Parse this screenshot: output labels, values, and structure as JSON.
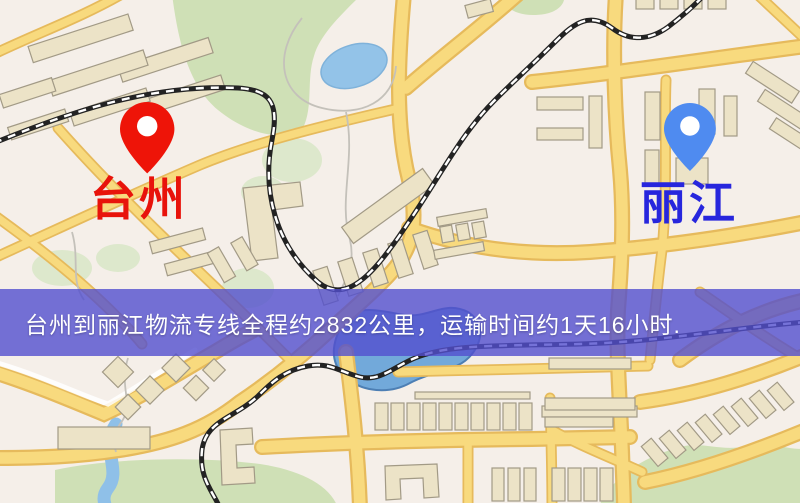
{
  "map": {
    "banner": {
      "text": "台州到丽江物流专线全程约2832公里，运输时间约1天16小时.",
      "background_color": "#524fce",
      "text_color": "#ffffff"
    },
    "markers": [
      {
        "id": "origin",
        "label": "台州",
        "pin_color": "#ee1408",
        "label_color": "#e8130b"
      },
      {
        "id": "destination",
        "label": "丽江",
        "pin_color": "#4f8bf0",
        "label_color": "#2726dd"
      }
    ],
    "route": {
      "distance_km": "2832",
      "duration": "1天16小时"
    },
    "colors": {
      "background": "#f5efe9",
      "road_fill": "#f8da7e",
      "road_casing": "#e6ba5c",
      "water": "#93c3e8",
      "lake_deep": "#72a9da",
      "green_area": "#cfe0b6",
      "building_fill": "#ece3c7",
      "building_outline": "#a29a86",
      "railway": "#232323"
    }
  }
}
